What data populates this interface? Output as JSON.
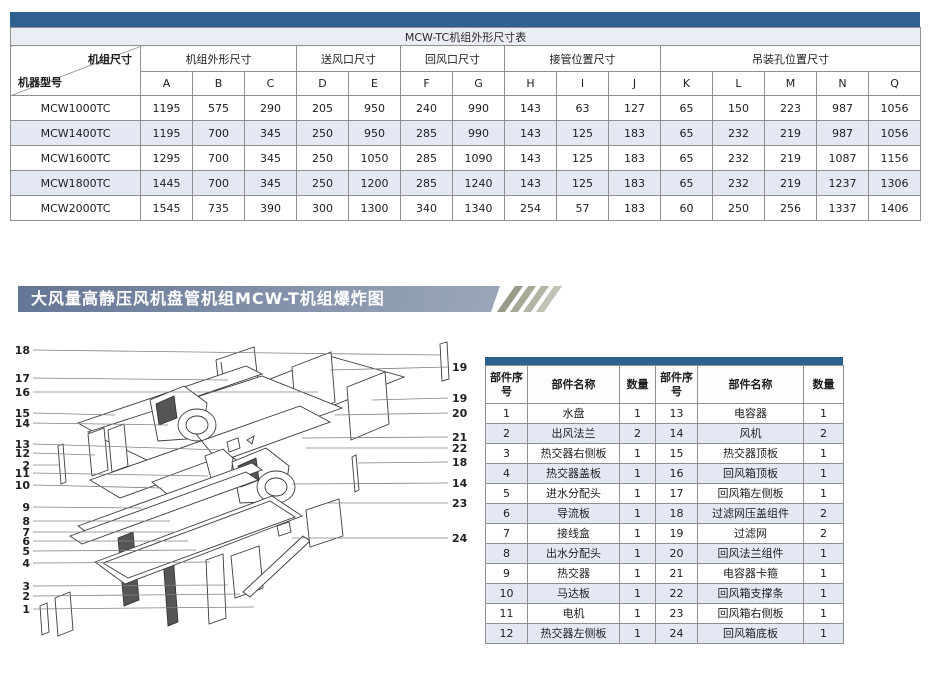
{
  "colors": {
    "table_bar_blue": "#2e618f",
    "row_shade": "#e3e8f3",
    "title_row_bg": "#eaedf4",
    "banner_gradient_left": "#637695",
    "banner_gradient_right": "#9aa7ba",
    "stripe_colors": [
      "#999a89",
      "#a7a898",
      "#b4b5a5",
      "#c2c3b4"
    ]
  },
  "dimension_table": {
    "title": "MCW-TC机组外形尺寸表",
    "corner": {
      "top_right": "机组尺寸",
      "bottom_left": "机器型号"
    },
    "groups": [
      {
        "label": "机组外形尺寸",
        "cols": [
          "A",
          "B",
          "C"
        ]
      },
      {
        "label": "送风口尺寸",
        "cols": [
          "D",
          "E"
        ]
      },
      {
        "label": "回风口尺寸",
        "cols": [
          "F",
          "G"
        ]
      },
      {
        "label": "接管位置尺寸",
        "cols": [
          "H",
          "I",
          "J"
        ]
      },
      {
        "label": "吊装孔位置尺寸",
        "cols": [
          "K",
          "L",
          "M",
          "N",
          "Q"
        ]
      }
    ],
    "rows": [
      {
        "model": "MCW1000TC",
        "values": [
          "1195",
          "575",
          "290",
          "205",
          "950",
          "240",
          "990",
          "143",
          "63",
          "127",
          "65",
          "150",
          "223",
          "987",
          "1056"
        ]
      },
      {
        "model": "MCW1400TC",
        "values": [
          "1195",
          "700",
          "345",
          "250",
          "950",
          "285",
          "990",
          "143",
          "125",
          "183",
          "65",
          "232",
          "219",
          "987",
          "1056"
        ]
      },
      {
        "model": "MCW1600TC",
        "values": [
          "1295",
          "700",
          "345",
          "250",
          "1050",
          "285",
          "1090",
          "143",
          "125",
          "183",
          "65",
          "232",
          "219",
          "1087",
          "1156"
        ]
      },
      {
        "model": "MCW1800TC",
        "values": [
          "1445",
          "700",
          "345",
          "250",
          "1200",
          "285",
          "1240",
          "143",
          "125",
          "183",
          "65",
          "232",
          "219",
          "1237",
          "1306"
        ]
      },
      {
        "model": "MCW2000TC",
        "values": [
          "1545",
          "735",
          "390",
          "300",
          "1300",
          "340",
          "1340",
          "254",
          "57",
          "183",
          "60",
          "250",
          "256",
          "1337",
          "1406"
        ]
      }
    ]
  },
  "section_banner": {
    "title": "大风量高静压风机盘管机组MCW-T机组爆炸图"
  },
  "exploded_diagram": {
    "left_labels": [
      "18",
      "17",
      "16",
      "15",
      "14",
      "13",
      "12",
      "2",
      "11",
      "10",
      "9",
      "8",
      "7",
      "6",
      "5",
      "4",
      "3",
      "2",
      "1"
    ],
    "right_labels": [
      "19",
      "19",
      "20",
      "21",
      "22",
      "18",
      "14",
      "23",
      "24"
    ]
  },
  "parts_table": {
    "headers": [
      "部件序号",
      "部件名称",
      "数量",
      "部件序号",
      "部件名称",
      "数量"
    ],
    "rows": [
      [
        "1",
        "水盘",
        "1",
        "13",
        "电容器",
        "1"
      ],
      [
        "2",
        "出风法兰",
        "2",
        "14",
        "风机",
        "2"
      ],
      [
        "3",
        "热交器右侧板",
        "1",
        "15",
        "热交器顶板",
        "1"
      ],
      [
        "4",
        "热交器盖板",
        "1",
        "16",
        "回风箱顶板",
        "1"
      ],
      [
        "5",
        "进水分配头",
        "1",
        "17",
        "回风箱左侧板",
        "1"
      ],
      [
        "6",
        "导流板",
        "1",
        "18",
        "过滤网压盖组件",
        "2"
      ],
      [
        "7",
        "接线盒",
        "1",
        "19",
        "过滤网",
        "2"
      ],
      [
        "8",
        "出水分配头",
        "1",
        "20",
        "回风法兰组件",
        "1"
      ],
      [
        "9",
        "热交器",
        "1",
        "21",
        "电容器卡箍",
        "1"
      ],
      [
        "10",
        "马达板",
        "1",
        "22",
        "回风箱支撑条",
        "1"
      ],
      [
        "11",
        "电机",
        "1",
        "23",
        "回风箱右侧板",
        "1"
      ],
      [
        "12",
        "热交器左侧板",
        "1",
        "24",
        "回风箱底板",
        "1"
      ]
    ]
  }
}
